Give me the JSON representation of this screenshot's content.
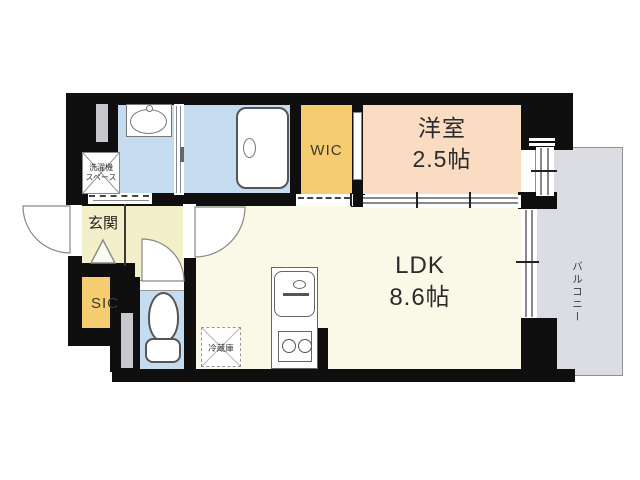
{
  "plan": {
    "rooms": {
      "ldk": {
        "name": "LDK",
        "area": "8.6帖"
      },
      "western_room": {
        "name": "洋室",
        "area": "2.5帖"
      },
      "wic": {
        "name": "WIC"
      },
      "sic": {
        "name": "SIC"
      },
      "genkan": {
        "name": "玄関"
      },
      "balcony": {
        "name": "バルコニー"
      },
      "washer_space": {
        "line1": "洗濯機",
        "line2": "スペース"
      },
      "fridge": {
        "name": "冷蔵庫"
      }
    },
    "colors": {
      "wall": "#0f0f0f",
      "water_rooms": "#c5dcf0",
      "closet_gold": "#f5cd70",
      "western_room_peach": "#f9dcc2",
      "ldk_cream": "#faf8e6",
      "hall_cream": "#f3efc8",
      "balcony_gray": "#dcdce3"
    }
  }
}
